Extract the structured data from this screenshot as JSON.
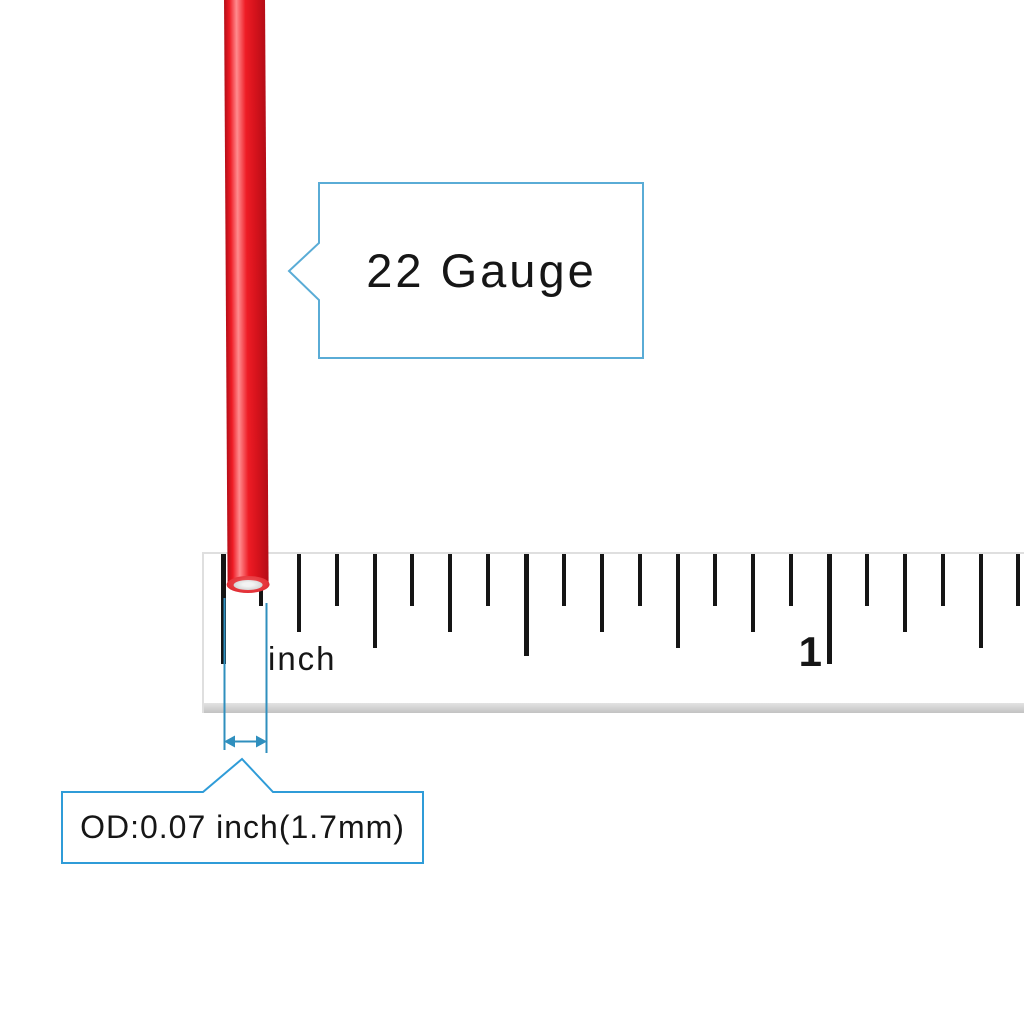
{
  "scene": {
    "type": "product-measurement-illustration",
    "subject": "22 gauge red wire measured against an inch ruler"
  },
  "colors": {
    "background": "#ffffff",
    "wire_red_edge": "#b50d17",
    "wire_red_main": "#ee1c25",
    "wire_red_highlight": "#ff8b8e",
    "wire_red_shadow": "#d6131c",
    "wire_cap_red": "#e5343a",
    "wire_core_gray": "#d6d6d6",
    "callout_border": "#2f9cd8",
    "callout_border_light": "#5aacd6",
    "dimension_blue": "#2f8fbe",
    "tick_color": "#151515",
    "ruler_edge": "#c2c2c2",
    "ruler_border": "#dfdfdf",
    "text_color": "#161616"
  },
  "callouts": {
    "gauge": {
      "label": "22 Gauge"
    },
    "od": {
      "label": "OD:0.07 inch(1.7mm)"
    }
  },
  "ruler": {
    "unit_label": "inch",
    "inch_mark_label": "1",
    "ticks_per_inch": 16,
    "pixels_per_inch": 606,
    "zero_x": 221,
    "tick_count": 22
  },
  "measurement": {
    "gauge": "22",
    "outer_diameter_inch": 0.07,
    "outer_diameter_mm": 1.7
  }
}
